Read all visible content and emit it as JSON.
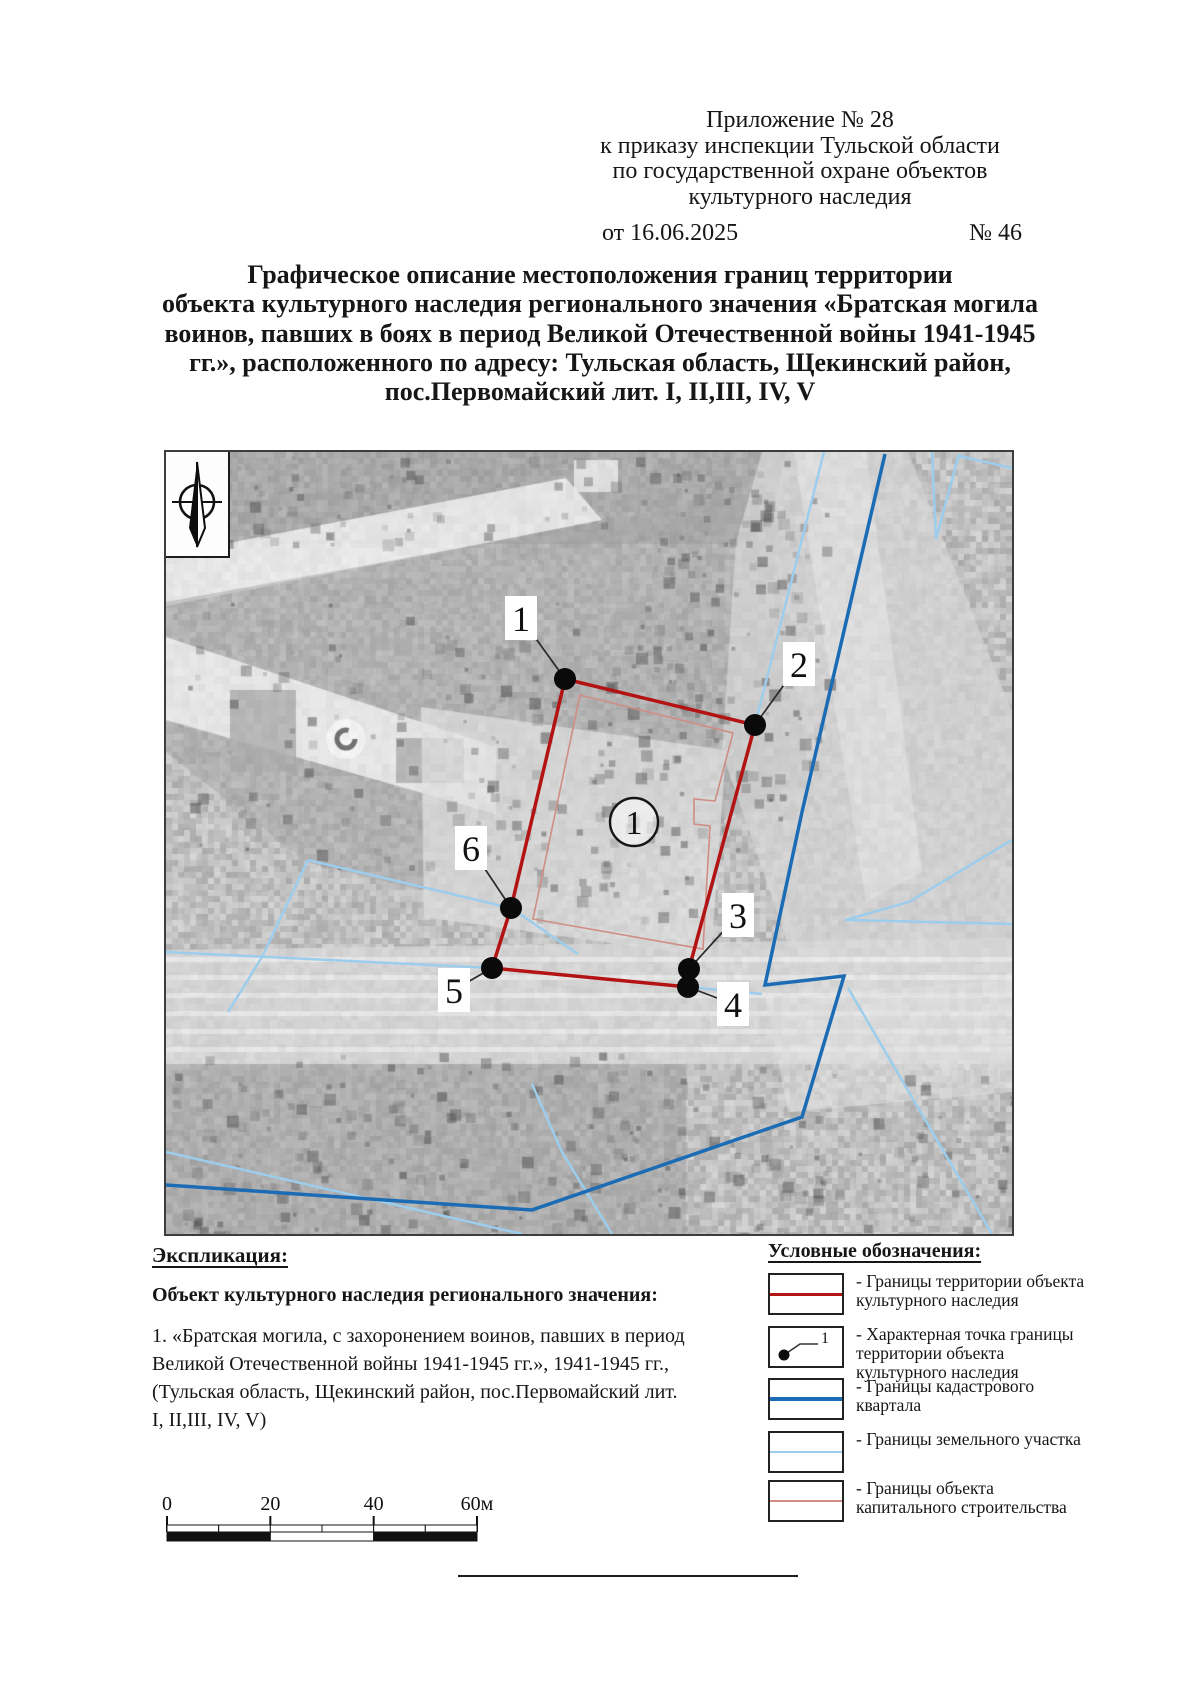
{
  "header": {
    "lines": [
      "Приложение № 28",
      "к приказу инспекции Тульской области",
      "по государственной охране объектов",
      "культурного наследия"
    ],
    "date": "от 16.06.2025",
    "doc_number": "№ 46"
  },
  "title_lines": [
    "Графическое описание местоположения границ территории",
    "объекта культурного наследия регионального значения «Братская могила",
    "воинов, павших в боях в период Великой Отечественной войны 1941-1945",
    "гг.», расположенного по адресу: Тульская область, Щекинский район,",
    "пос.Первомайский лит. I, II,III, IV, V"
  ],
  "map": {
    "object_label": "1",
    "points": [
      {
        "label": "1",
        "x": 399,
        "y": 227,
        "lx": 355,
        "ly": 166
      },
      {
        "label": "2",
        "x": 589,
        "y": 273,
        "lx": 633,
        "ly": 212
      },
      {
        "label": "3",
        "x": 523,
        "y": 517,
        "lx": 572,
        "ly": 463
      },
      {
        "label": "4",
        "x": 522,
        "y": 535,
        "lx": 567,
        "ly": 552
      },
      {
        "label": "5",
        "x": 326,
        "y": 516,
        "lx": 288,
        "ly": 538
      },
      {
        "label": "6",
        "x": 345,
        "y": 456,
        "lx": 305,
        "ly": 396
      }
    ]
  },
  "explication": {
    "heading": "Экспликация:",
    "subheading": "Объект культурного наследия регионального значения:",
    "item_lines": [
      "1. «Братская могила, с захоронением воинов, павших в период",
      "Великой Отечественной войны 1941-1945 гг.», 1941-1945 гг.,",
      "(Тульская область, Щекинский район, пос.Первомайский лит.",
      "I, II,III, IV, V)"
    ]
  },
  "legend": {
    "heading": "Условные обозначения:",
    "point_symbol_number": "1",
    "items": [
      {
        "symbol": "territory-line",
        "label_lines": [
          "- Границы территории объекта",
          "культурного наследия"
        ]
      },
      {
        "symbol": "characteristic-point",
        "label_lines": [
          "- Характерная точка границы",
          "территории объекта",
          "культурного наследия"
        ]
      },
      {
        "symbol": "cadastral-line",
        "label_lines": [
          "- Границы кадастрового",
          "квартала"
        ]
      },
      {
        "symbol": "parcel-line",
        "label_lines": [
          "- Границы земельного участка"
        ]
      },
      {
        "symbol": "construction-line",
        "label_lines": [
          "- Границы объекта",
          "капитального строительства"
        ]
      }
    ]
  },
  "scale_bar": {
    "labels": [
      "0",
      "20",
      "40",
      "60м"
    ]
  },
  "colors": {
    "territory_boundary": "#b31312",
    "cadastral_boundary": "#1c6cb5",
    "parcel_boundary": "#9dcdec",
    "construction_boundary": "#cf8d84"
  }
}
